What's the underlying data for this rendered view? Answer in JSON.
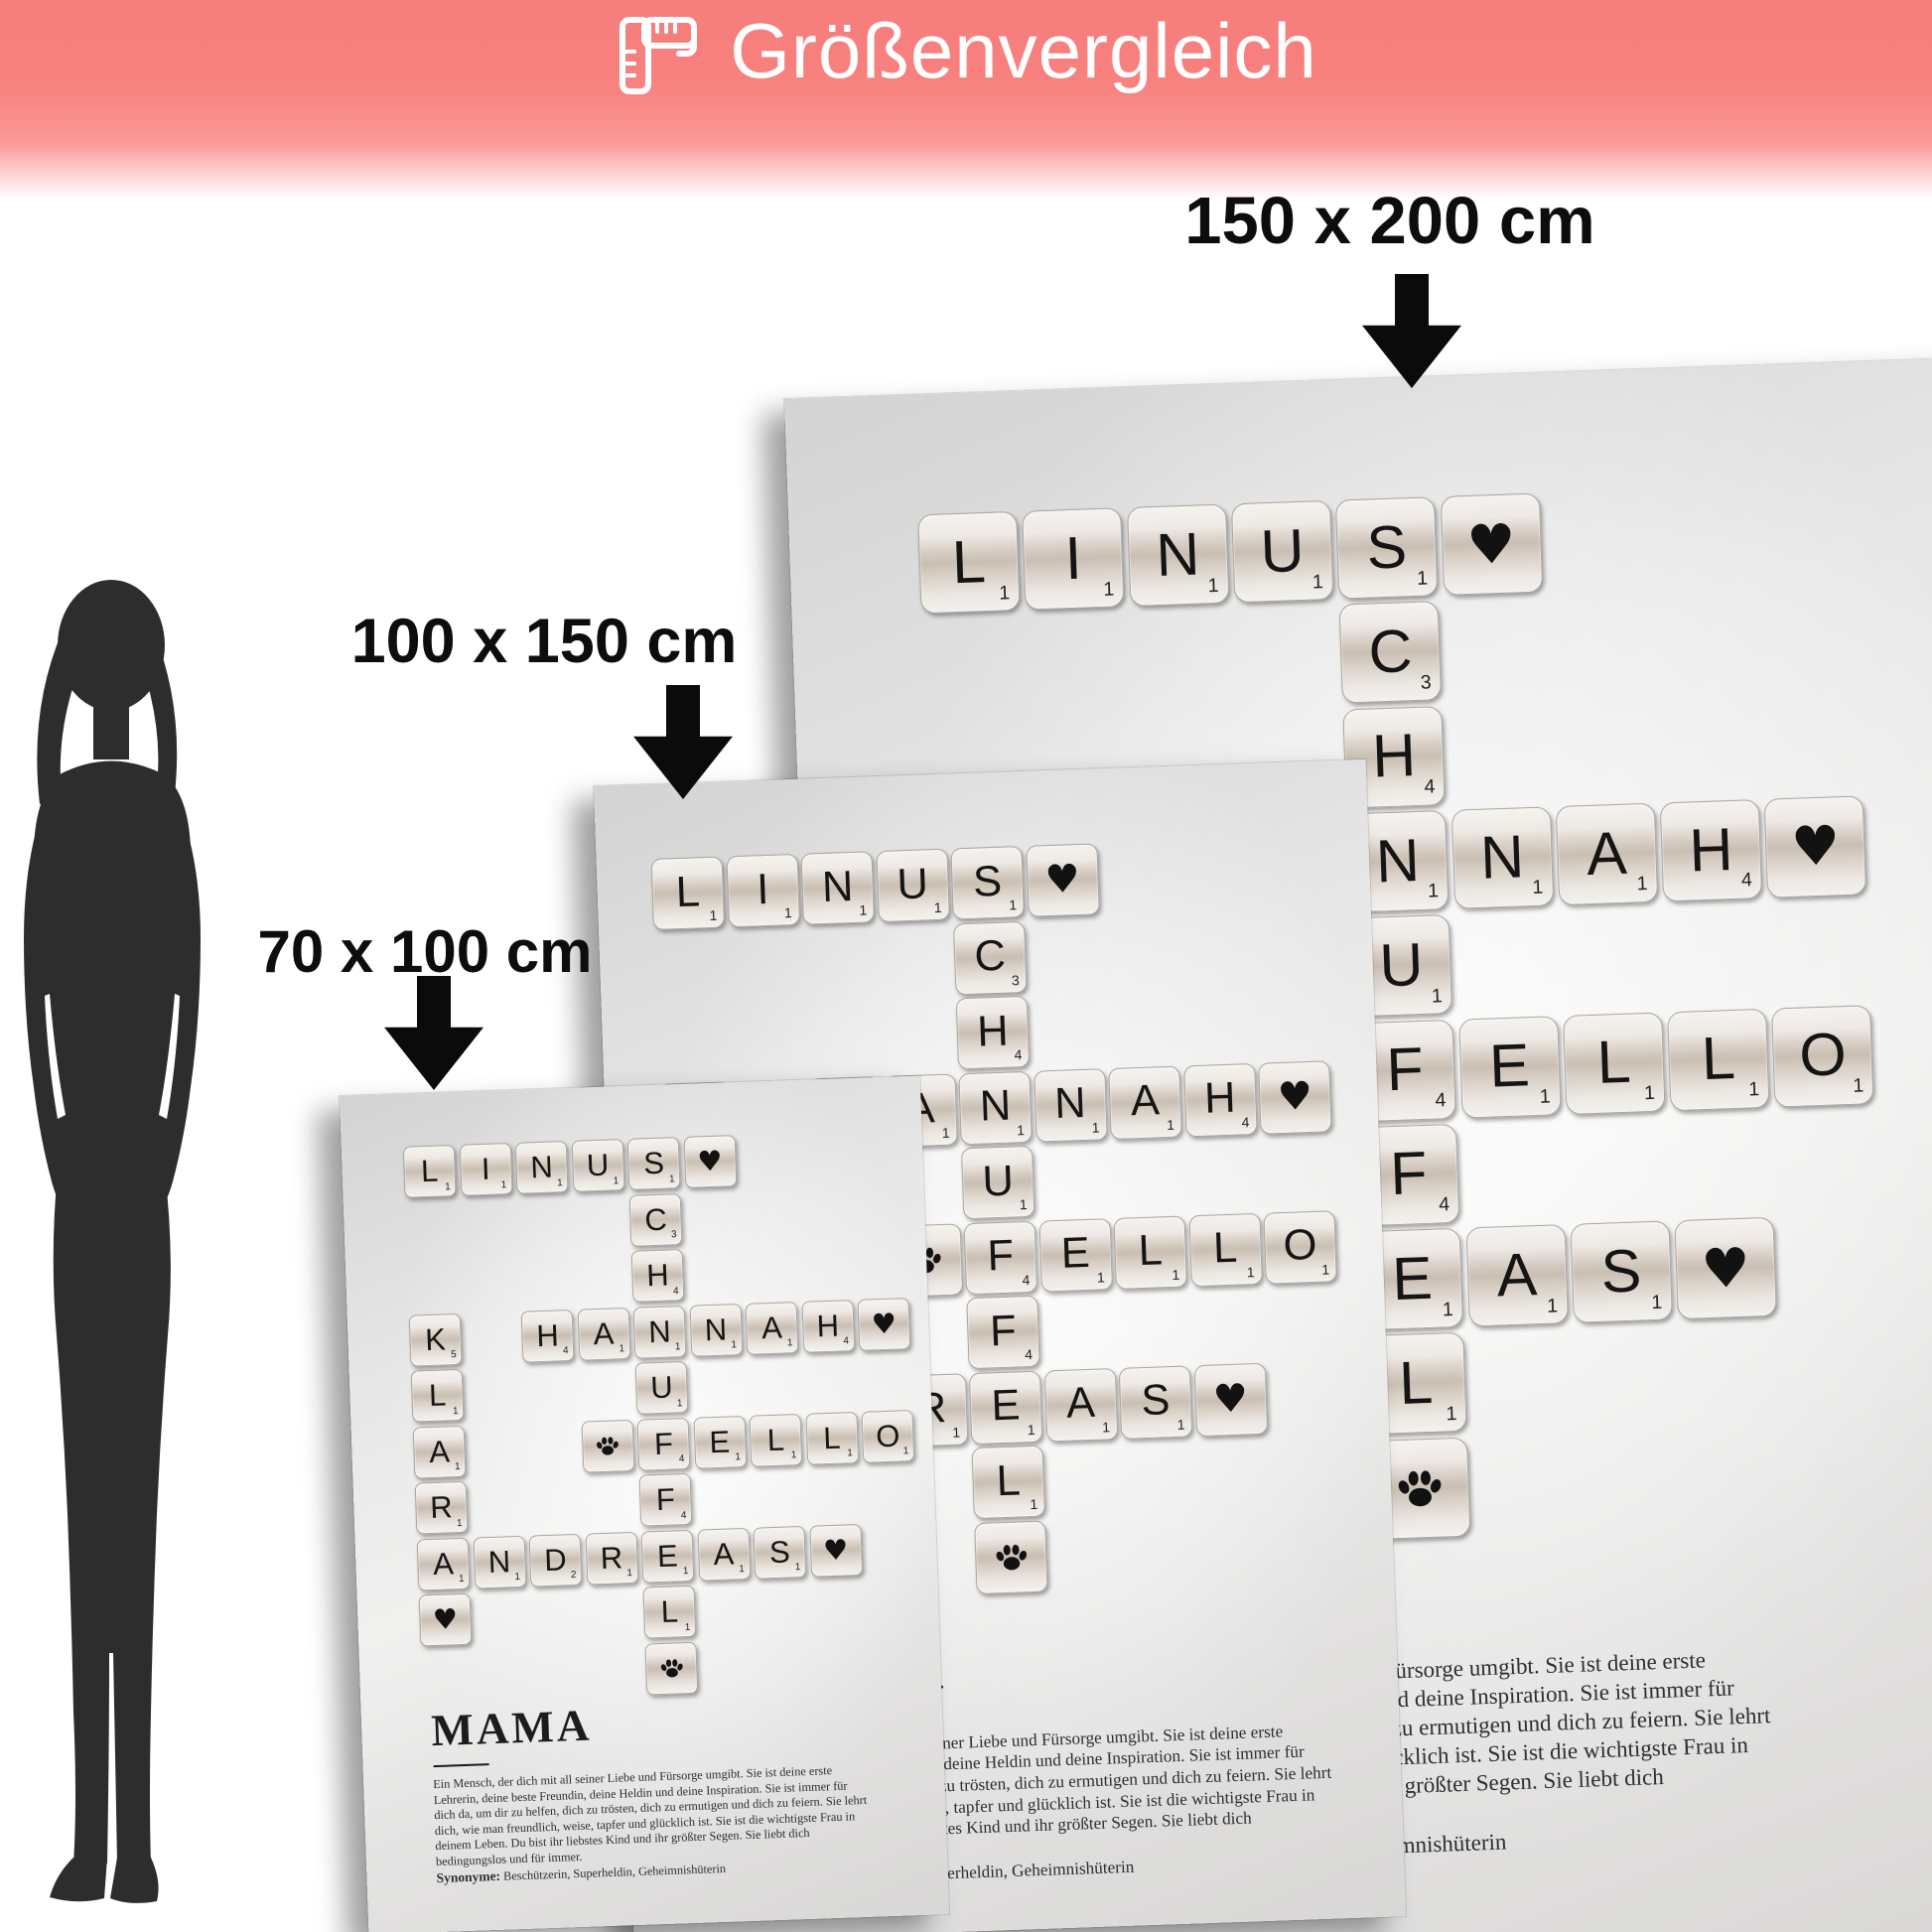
{
  "banner": {
    "title": "Größenvergleich",
    "color": "#f8827f",
    "icon": "ruler-icon"
  },
  "size_labels": [
    {
      "text": "150 x 200 cm"
    },
    {
      "text": "100 x 150 cm"
    },
    {
      "text": "70 x 100 cm"
    }
  ],
  "poster": {
    "title": "MAMA",
    "definition_lines": [
      "Ein Mensch, der dich mit all seiner Liebe und Fürsorge umgibt. Sie ist deine erste",
      "Lehrerin, deine beste Freundin, deine Heldin und deine Inspiration. Sie ist immer für",
      "dich da, um dir zu helfen, dich zu trösten, dich zu ermutigen und dich zu feiern. Sie lehrt",
      "dich, wie man freundlich, weise, tapfer und glücklich ist. Sie ist die wichtigste Frau in",
      "deinem Leben. Du bist ihr liebstes Kind und ihr größter Segen. Sie liebt dich",
      "bedingungslos und für immer."
    ],
    "synonyms_label": "Synonyme:",
    "synonyms": "Beschützerin, Superheldin, Geheimnishüterin",
    "names": [
      "LINUS",
      "SCHNUFFEL",
      "HANNAH",
      "KLARA",
      "FELLO",
      "ANDREAS"
    ],
    "tiles": [
      {
        "r": 0,
        "c": 0,
        "type": "letter",
        "ch": "L",
        "v": 1
      },
      {
        "r": 0,
        "c": 1,
        "type": "letter",
        "ch": "I",
        "v": 1
      },
      {
        "r": 0,
        "c": 2,
        "type": "letter",
        "ch": "N",
        "v": 1
      },
      {
        "r": 0,
        "c": 3,
        "type": "letter",
        "ch": "U",
        "v": 1
      },
      {
        "r": 0,
        "c": 4,
        "type": "letter",
        "ch": "S",
        "v": 1
      },
      {
        "r": 0,
        "c": 5,
        "type": "heart"
      },
      {
        "r": 1,
        "c": 4,
        "type": "letter",
        "ch": "C",
        "v": 3
      },
      {
        "r": 2,
        "c": 4,
        "type": "letter",
        "ch": "H",
        "v": 4
      },
      {
        "r": 3,
        "c": 0,
        "type": "letter",
        "ch": "K",
        "v": 5
      },
      {
        "r": 3,
        "c": 2,
        "type": "letter",
        "ch": "H",
        "v": 4
      },
      {
        "r": 3,
        "c": 3,
        "type": "letter",
        "ch": "A",
        "v": 1
      },
      {
        "r": 3,
        "c": 4,
        "type": "letter",
        "ch": "N",
        "v": 1
      },
      {
        "r": 3,
        "c": 5,
        "type": "letter",
        "ch": "N",
        "v": 1
      },
      {
        "r": 3,
        "c": 6,
        "type": "letter",
        "ch": "A",
        "v": 1
      },
      {
        "r": 3,
        "c": 7,
        "type": "letter",
        "ch": "H",
        "v": 4
      },
      {
        "r": 3,
        "c": 8,
        "type": "heart"
      },
      {
        "r": 4,
        "c": 0,
        "type": "letter",
        "ch": "L",
        "v": 1
      },
      {
        "r": 4,
        "c": 4,
        "type": "letter",
        "ch": "U",
        "v": 1
      },
      {
        "r": 5,
        "c": 0,
        "type": "letter",
        "ch": "A",
        "v": 1
      },
      {
        "r": 5,
        "c": 3,
        "type": "paw"
      },
      {
        "r": 5,
        "c": 4,
        "type": "letter",
        "ch": "F",
        "v": 4
      },
      {
        "r": 5,
        "c": 5,
        "type": "letter",
        "ch": "E",
        "v": 1
      },
      {
        "r": 5,
        "c": 6,
        "type": "letter",
        "ch": "L",
        "v": 1
      },
      {
        "r": 5,
        "c": 7,
        "type": "letter",
        "ch": "L",
        "v": 1
      },
      {
        "r": 5,
        "c": 8,
        "type": "letter",
        "ch": "O",
        "v": 1
      },
      {
        "r": 6,
        "c": 0,
        "type": "letter",
        "ch": "R",
        "v": 1
      },
      {
        "r": 6,
        "c": 4,
        "type": "letter",
        "ch": "F",
        "v": 4
      },
      {
        "r": 7,
        "c": 0,
        "type": "letter",
        "ch": "A",
        "v": 1
      },
      {
        "r": 7,
        "c": 1,
        "type": "letter",
        "ch": "N",
        "v": 1
      },
      {
        "r": 7,
        "c": 2,
        "type": "letter",
        "ch": "D",
        "v": 2
      },
      {
        "r": 7,
        "c": 3,
        "type": "letter",
        "ch": "R",
        "v": 1
      },
      {
        "r": 7,
        "c": 4,
        "type": "letter",
        "ch": "E",
        "v": 1
      },
      {
        "r": 7,
        "c": 5,
        "type": "letter",
        "ch": "A",
        "v": 1
      },
      {
        "r": 7,
        "c": 6,
        "type": "letter",
        "ch": "S",
        "v": 1
      },
      {
        "r": 7,
        "c": 7,
        "type": "heart"
      },
      {
        "r": 8,
        "c": 0,
        "type": "heart"
      },
      {
        "r": 8,
        "c": 4,
        "type": "letter",
        "ch": "L",
        "v": 1
      },
      {
        "r": 9,
        "c": 4,
        "type": "paw"
      }
    ]
  }
}
